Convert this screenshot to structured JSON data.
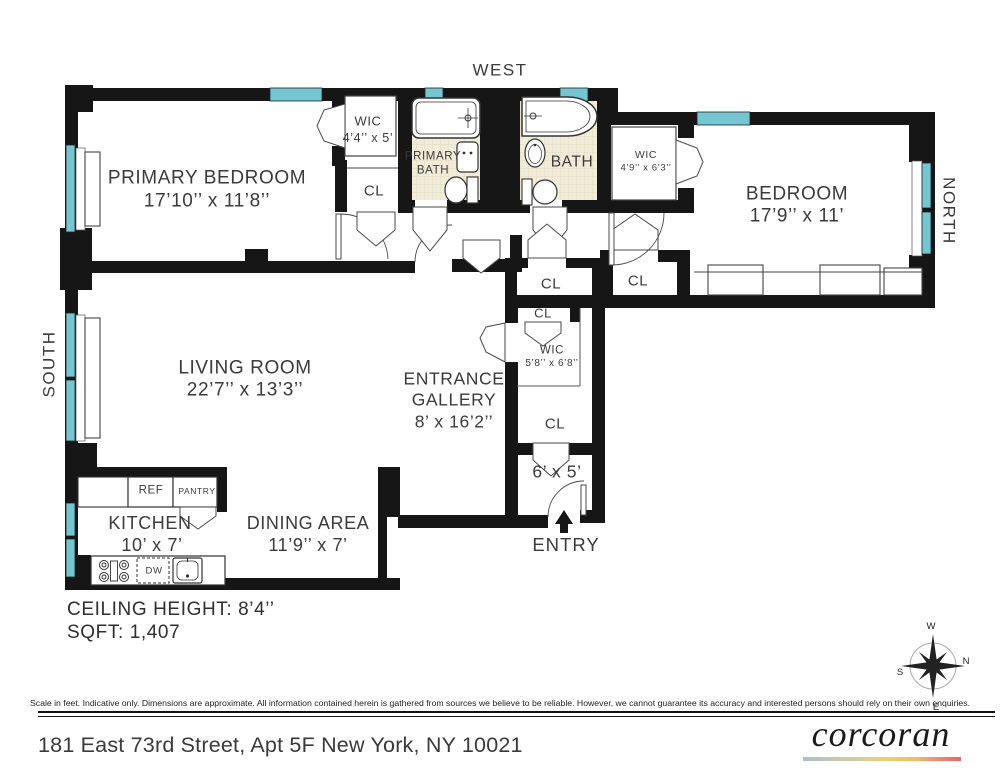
{
  "orientation": {
    "west": "WEST",
    "north": "NORTH",
    "south": "SOUTH"
  },
  "compass": {
    "w": "W",
    "n": "N",
    "s": "S",
    "e": "E"
  },
  "rooms": {
    "primary_bedroom": {
      "name": "PRIMARY BEDROOM",
      "dims": "17’10’’ x 11’8’’"
    },
    "bedroom": {
      "name": "BEDROOM",
      "dims": "17’9’’ x 11’"
    },
    "living_room": {
      "name": "LIVING ROOM",
      "dims": "22’7’’ x 13’3’’"
    },
    "entrance_gallery": {
      "name_line1": "ENTRANCE",
      "name_line2": "GALLERY",
      "dims": "8’ x 16’2’’"
    },
    "kitchen": {
      "name": "KITCHEN",
      "dims": "10’ x 7’"
    },
    "dining_area": {
      "name": "DINING AREA",
      "dims": "11’9’’ x 7’"
    },
    "primary_bath": {
      "name_line1": "PRIMARY",
      "name_line2": "BATH"
    },
    "bath": {
      "name": "BATH"
    },
    "wic_primary": {
      "name": "WIC",
      "dims": "4’4’’ x 5’"
    },
    "wic_bedroom": {
      "name": "WIC",
      "dims": "4’9’’ x 6’3’’"
    },
    "wic_gallery": {
      "name": "WIC",
      "dims": "5’8’’ x 6’8’’"
    },
    "vestibule": {
      "dims": "6’ x 5’"
    },
    "entry": {
      "name": "ENTRY"
    }
  },
  "closets": [
    "CL",
    "CL",
    "CL",
    "CL",
    "CL"
  ],
  "appliances": {
    "ref": "REF",
    "pantry": "PANTRY",
    "dw": "DW"
  },
  "stats": {
    "ceiling_height": "CEILING HEIGHT: 8’4’’",
    "sqft": "SQFT: 1,407"
  },
  "footer": {
    "disclaimer": "Scale in feet. Indicative only. Dimensions are approximate. All information contained herein is gathered from sources we believe to be reliable. However, we cannot guarantee its accuracy and interested persons should rely on their own enquiries.",
    "address": "181 East 73rd Street, Apt 5F New York, NY 10021",
    "brand": "corcoran"
  },
  "colors": {
    "wall": "#161616",
    "window": "#76c5d2",
    "bath_floor": "#f1ecda",
    "brand_gradient_start": "#aebfca",
    "brand_gradient_mid": "#edd06b",
    "brand_gradient_end": "#e96565"
  }
}
